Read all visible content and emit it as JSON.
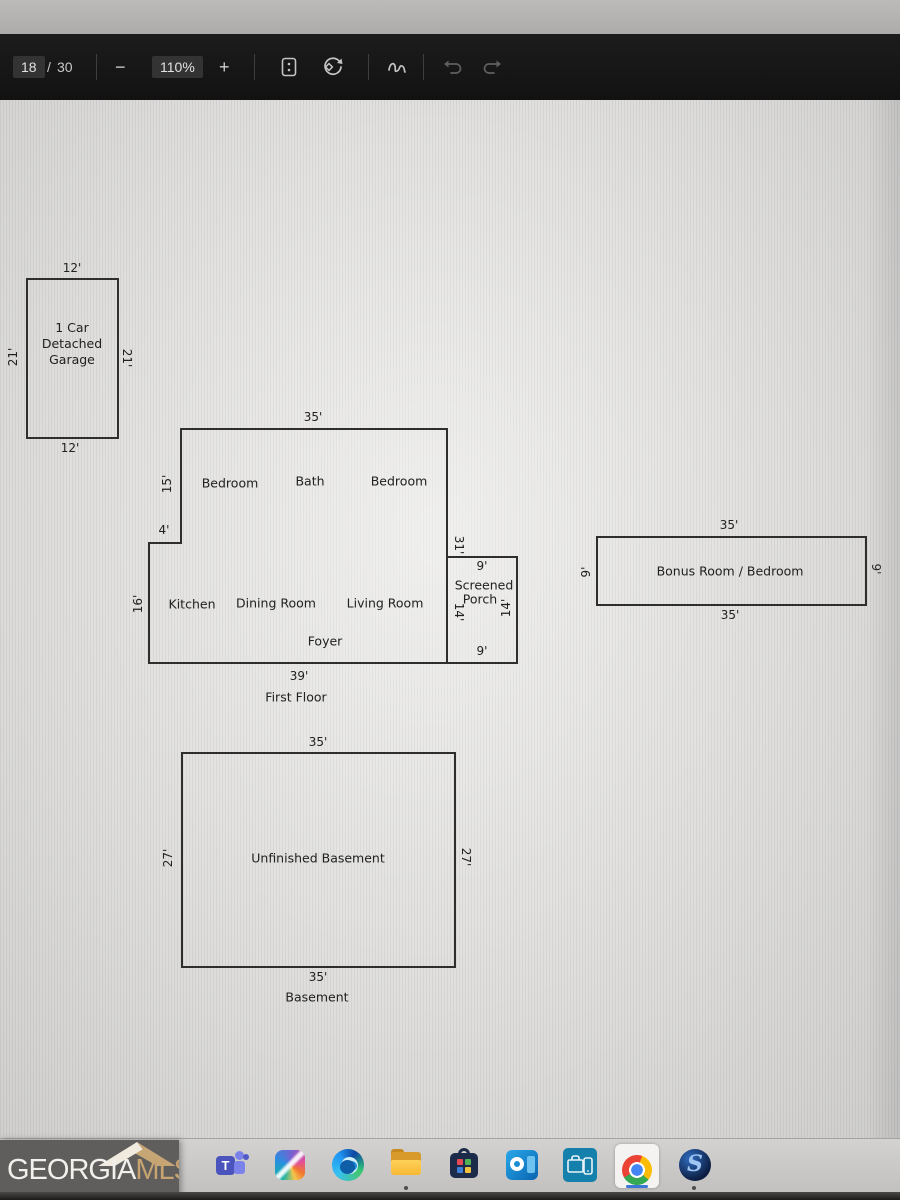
{
  "viewer_toolbar": {
    "page_current": "18",
    "page_separator": "/",
    "page_total": "30",
    "zoom_out_label": "−",
    "zoom_level": "110%",
    "zoom_in_label": "+",
    "icons": [
      "fit-to-page-icon",
      "rotate-icon",
      "draw-icon",
      "undo-icon",
      "redo-icon"
    ]
  },
  "floor_plan": {
    "garage": {
      "name_line1": "1 Car",
      "name_line2": "Detached",
      "name_line3": "Garage",
      "dim_top": "12'",
      "dim_bottom": "12'",
      "dim_left": "21'",
      "dim_right": "21'"
    },
    "first_floor": {
      "caption": "First Floor",
      "dim_top": "35'",
      "dim_bottom": "39'",
      "dim_left_upper": "15'",
      "dim_step": "4'",
      "dim_left_lower": "16'",
      "dim_right": "31'",
      "rooms": {
        "bedroom_left": "Bedroom",
        "bath": "Bath",
        "bedroom_right": "Bedroom",
        "kitchen": "Kitchen",
        "dining": "Dining Room",
        "living": "Living Room",
        "foyer": "Foyer"
      },
      "porch": {
        "line1": "Screened",
        "line2": "Porch",
        "dim_top": "9'",
        "dim_bottom": "9'",
        "dim_left": "14'",
        "dim_right": "14'"
      }
    },
    "bonus_room": {
      "label": "Bonus Room / Bedroom",
      "dim_top": "35'",
      "dim_bottom": "35'",
      "dim_left": "9'",
      "dim_right": "9'"
    },
    "basement": {
      "label": "Unfinished Basement",
      "caption": "Basement",
      "dim_top": "35'",
      "dim_bottom": "35'",
      "dim_left": "27'",
      "dim_right": "27'"
    }
  },
  "taskbar": {
    "logo": {
      "brand_left": "GEORGIA",
      "brand_right": "MLS",
      "tagline": "REAL ESTATE SERVICES"
    },
    "icons": [
      "teams",
      "copilot",
      "edge",
      "file-explorer",
      "microsoft-store",
      "outlook",
      "company-portal",
      "chrome",
      "supra"
    ],
    "active_app": "chrome"
  },
  "colors": {
    "toolbar_bg": "#161616",
    "paper": "#dddcda",
    "plan_line": "#2e2e2e",
    "taskbar_bg": "#c9c8c6",
    "logo_box": "#5f5e5d",
    "logo_tan": "#c7a371",
    "chrome_active_bar": "#3b77d6"
  }
}
